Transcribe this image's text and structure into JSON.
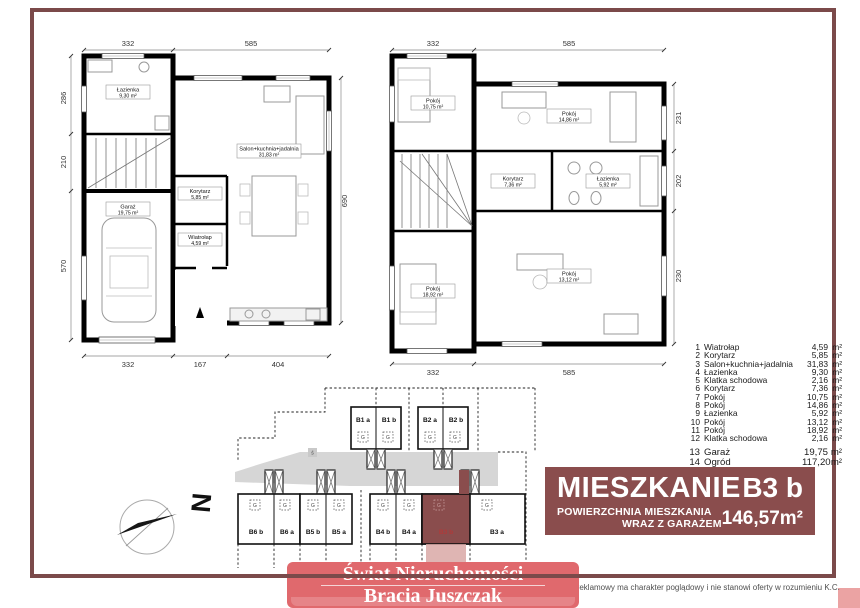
{
  "colors": {
    "frame_border": "#7b4a4a",
    "info_panel_bg": "#8a4d4d",
    "banner_bg": "#e0696d",
    "highlight_unit": "#8a4d4d",
    "garden_strip": "#d9a8a6",
    "road": "#d6d6d6"
  },
  "ground_floor": {
    "rooms": {
      "lazienka": {
        "name": "Łazienka",
        "area": "9,30 m²"
      },
      "salon": {
        "name": "Salon+kuchnia+jadalnia",
        "area": "31,83 m²"
      },
      "korytarz": {
        "name": "Korytarz",
        "area": "5,85 m²"
      },
      "wiatrolap": {
        "name": "Wiatrołap",
        "area": "4,59 m²"
      },
      "garaz": {
        "name": "Garaż",
        "area": "19,75 m²"
      }
    },
    "dims": {
      "top": [
        "332",
        "585"
      ],
      "left": [
        "286",
        "210",
        "570"
      ],
      "right": [
        "690"
      ],
      "bottom": [
        "332",
        "167",
        "404"
      ]
    }
  },
  "first_floor": {
    "rooms": {
      "pokoj_1": {
        "name": "Pokój",
        "area": "10,75 m²"
      },
      "pokoj_2": {
        "name": "Pokój",
        "area": "14,86 m²"
      },
      "korytarz": {
        "name": "Korytarz",
        "area": "7,36 m²"
      },
      "lazienka": {
        "name": "Łazienka",
        "area": "5,92 m²"
      },
      "pokoj_3": {
        "name": "Pokój",
        "area": "18,92 m²"
      },
      "pokoj_4": {
        "name": "Pokój",
        "area": "13,12 m²"
      }
    },
    "dims": {
      "top": [
        "332",
        "585"
      ],
      "right": [
        "231",
        "202",
        "230"
      ],
      "bottom": [
        "332",
        "585"
      ]
    }
  },
  "legend": {
    "items": [
      {
        "no": "1",
        "name": "Wiatrołap",
        "area": "4,59",
        "unit": "m²"
      },
      {
        "no": "2",
        "name": "Korytarz",
        "area": "5,85",
        "unit": "m²"
      },
      {
        "no": "3",
        "name": "Salon+kuchnia+jadalnia",
        "area": "31,83",
        "unit": "m²"
      },
      {
        "no": "4",
        "name": "Łazienka",
        "area": "9,30",
        "unit": "m²"
      },
      {
        "no": "5",
        "name": "Klatka schodowa",
        "area": "2,16",
        "unit": "m²"
      },
      {
        "no": "6",
        "name": "Korytarz",
        "area": "7,36",
        "unit": "m²"
      },
      {
        "no": "7",
        "name": "Pokój",
        "area": "10,75",
        "unit": "m²"
      },
      {
        "no": "8",
        "name": "Pokój",
        "area": "14,86",
        "unit": "m²"
      },
      {
        "no": "9",
        "name": "Łazienka",
        "area": "5,92",
        "unit": "m²"
      },
      {
        "no": "10",
        "name": "Pokój",
        "area": "13,12",
        "unit": "m²"
      },
      {
        "no": "11",
        "name": "Pokój",
        "area": "18,92",
        "unit": "m²"
      },
      {
        "no": "12",
        "name": "Klatka schodowa",
        "area": "2,16",
        "unit": "m²"
      },
      {
        "no": "13",
        "name": "Garaż",
        "area": "19,75",
        "unit": "m²"
      },
      {
        "no": "14",
        "name": "Ogród",
        "area": "117,20",
        "unit": "m²"
      }
    ]
  },
  "site_plan": {
    "units": {
      "b1a": "B1 a",
      "b1b": "B1 b",
      "b2a": "B2 a",
      "b2b": "B2 b",
      "b6b": "B6 b",
      "b6a": "B6 a",
      "b5b": "B5 b",
      "b5a": "B5 a",
      "b4b": "B4 b",
      "b4a": "B4 a",
      "b3b": "B3 b",
      "b3a": "B3 a"
    },
    "garage_label": "G",
    "road_label": "ś",
    "highlighted_unit": "B3 b"
  },
  "info_panel": {
    "title": "MIESZKANIE",
    "unit": "B3 b",
    "subtitle_line1": "POWIERZCHNIA MIESZKANIA",
    "subtitle_line2": "WRAZ Z GARAŻEM",
    "area": "146,57m²"
  },
  "compass": {
    "north_label": "N"
  },
  "branding": {
    "line1": "Świat Nieruchomości",
    "line2": "Bracia Juszczak"
  },
  "disclaimer": {
    "text": "Materiał reklamowy ma charakter poglądowy i nie stanowi oferty w rozumieniu K.C."
  }
}
